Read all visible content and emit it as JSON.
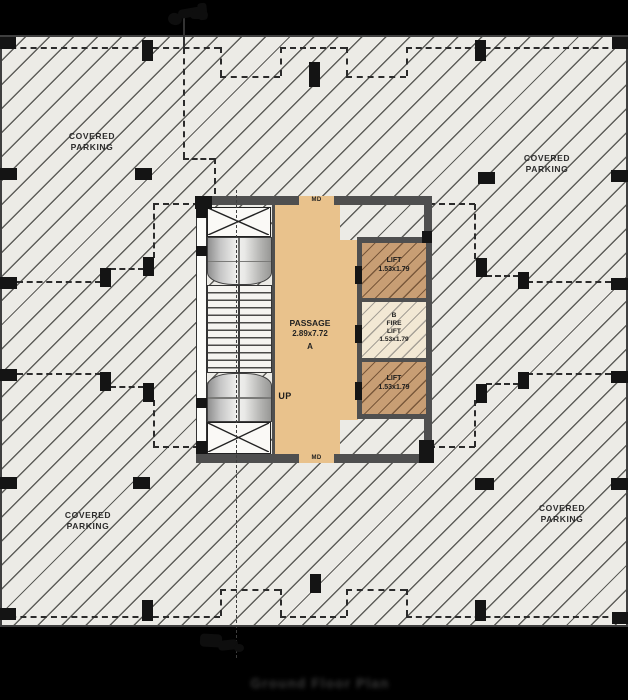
{
  "drawing": {
    "parking_label": {
      "line1": "COVERED",
      "line2": "PARKING"
    },
    "core": {
      "passage": {
        "title": "PASSAGE",
        "dims": "2.89x7.72",
        "zone": "A"
      },
      "up": "UP",
      "door_top": "MD",
      "door_bottom": "MD",
      "lift_top": {
        "title": "LIFT",
        "dims": "1.53x1.79"
      },
      "fire_lift": {
        "zone": "B",
        "line1": "FIRE",
        "line2": "LIFT",
        "dims": "1.53x1.79"
      },
      "lift_bottom": {
        "title": "LIFT",
        "dims": "1.53x1.79"
      }
    },
    "caption": "Ground Floor Plan",
    "colors": {
      "paper": "#ecebe6",
      "hatch_line": "#5e5e5a",
      "passage_fill": "#e9c28c",
      "lift_fill": "#c89e74",
      "fire_lift_fill": "#f2e8d4",
      "wall": "#4f4f4f",
      "ink": "#141414",
      "background": "#000000"
    }
  }
}
